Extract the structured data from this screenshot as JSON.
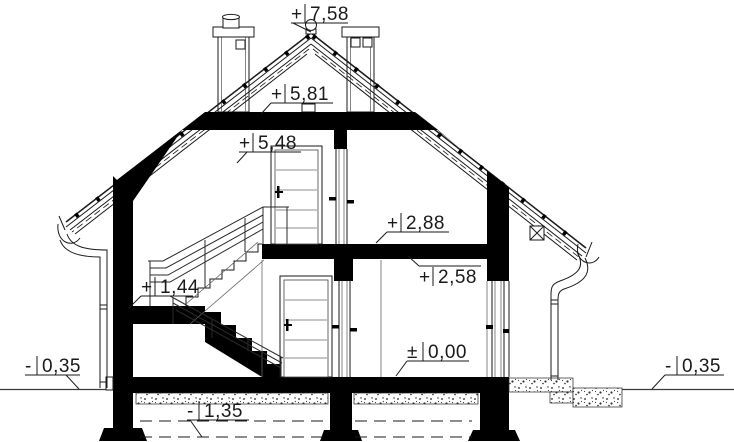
{
  "levels": [
    {
      "id": "ridge",
      "sign": "+",
      "value": "7,58"
    },
    {
      "id": "attic_ceiling_top",
      "sign": "+",
      "value": "5,81"
    },
    {
      "id": "attic_room_height",
      "sign": "+",
      "value": "5,48"
    },
    {
      "id": "upper_floor_top",
      "sign": "+",
      "value": "2,88"
    },
    {
      "id": "upper_floor_soffit",
      "sign": "+",
      "value": "2,58"
    },
    {
      "id": "stair_landing",
      "sign": "+",
      "value": "1,44"
    },
    {
      "id": "ground_floor",
      "sign": "±",
      "value": "0,00"
    },
    {
      "id": "grade_left",
      "sign": "-",
      "value": "0,35"
    },
    {
      "id": "foundation_depth",
      "sign": "-",
      "value": "1,35"
    },
    {
      "id": "grade_right",
      "sign": "-",
      "value": "0,35"
    }
  ],
  "colors": {
    "ink": "#1a1a1a",
    "cut_fill": "#000000",
    "background": "#ffffff"
  }
}
